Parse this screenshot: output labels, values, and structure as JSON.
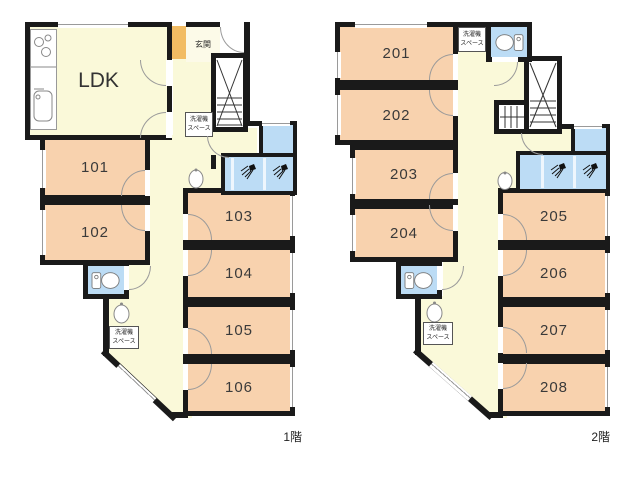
{
  "colors": {
    "wall": "#1a1a1a",
    "room-fill": "#f8d2ae",
    "hall-fill": "#faf9d9",
    "wet-fill": "#bcdcf5",
    "entrance-accent": "#f2bc63",
    "door-arc": "#9a9a9a"
  },
  "labels": {
    "ldk": "LDK",
    "entrance": "玄関",
    "washer_line1": "洗濯機",
    "washer_line2": "スペース"
  },
  "floor1": {
    "caption": "1階",
    "rooms": [
      "101",
      "102",
      "103",
      "104",
      "105",
      "106"
    ]
  },
  "floor2": {
    "caption": "2階",
    "rooms": [
      "201",
      "202",
      "203",
      "204",
      "205",
      "206",
      "207",
      "208"
    ]
  },
  "icons": {
    "stove": "stove-icon",
    "kitchen_sink": "kitchen-sink-icon",
    "toilet": "toilet-icon",
    "shower": "shower-icon",
    "washbasin": "washbasin-icon",
    "stairs": "stairs-icon",
    "door": "door-swing-arc",
    "window": "window-marker"
  }
}
